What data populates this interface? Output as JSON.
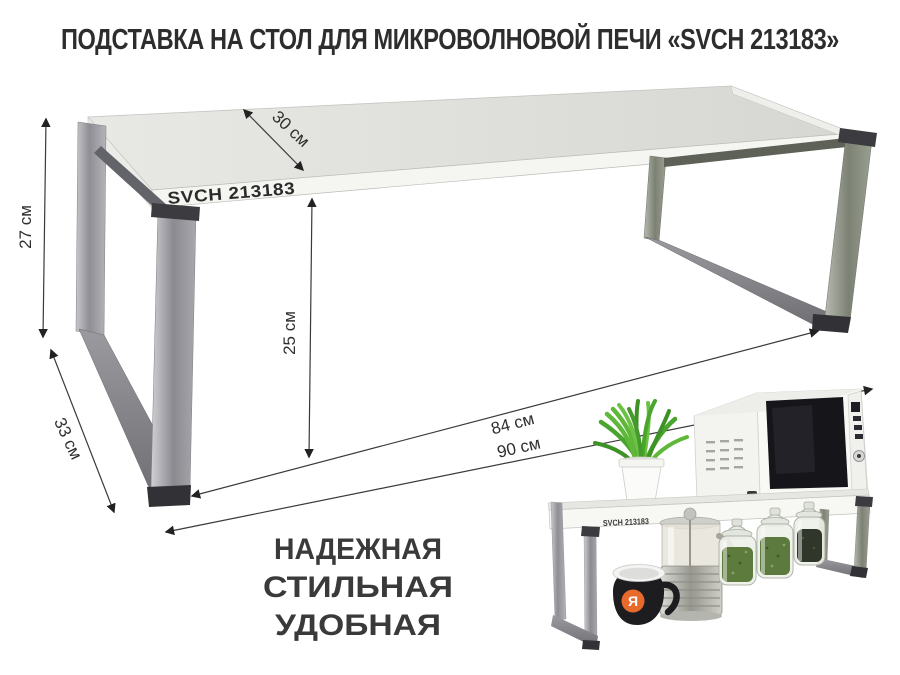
{
  "title": "ПОДСТАВКА НА СТОЛ ДЛЯ МИКРОВОЛНОВОЙ ПЕЧИ «SVCH 213183»",
  "product": {
    "model_label": "SVCH 213183"
  },
  "dimensions": {
    "height": "27 см",
    "top_depth": "30 см",
    "inner_height": "25 см",
    "base_depth": "33 см",
    "inner_width": "84 см",
    "outer_width": "90 см"
  },
  "slogan": {
    "line1": "НАДЕЖНАЯ",
    "line2": "СТИЛЬНАЯ",
    "line3": "УДОБНАЯ"
  },
  "inset": {
    "model_label": "SVCH 213183",
    "mug_logo_letter": "Я"
  },
  "colors": {
    "text": "#2d2d2d",
    "dimension_line": "#3a3a3a",
    "metal": "#9a9a9f",
    "accent_orange": "#e76a2b",
    "herb_green": "#5d7b3c"
  }
}
